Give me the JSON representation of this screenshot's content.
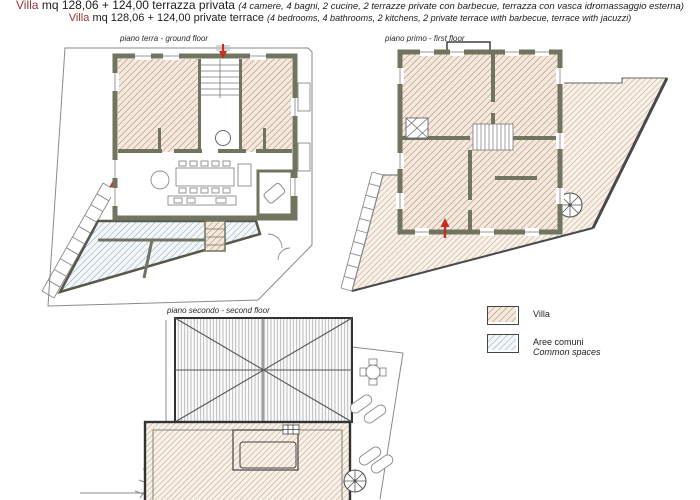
{
  "header": {
    "line1": {
      "brand": "Villa",
      "main": "mq 128,06 + 124,00 terrazza privata",
      "details": "(4 camere, 4 bagni, 2 cucine, 2 terrazze private con barbecue, terrazza con vasca idromassaggio esterna)"
    },
    "line2": {
      "brand": "Villa",
      "main": "mq 128,06 + 124,00 private terrace",
      "details": "(4 bedrooms, 4 bathrooms, 2 kitchens, 2 private terrace with barbecue, terrace with jacuzzi)"
    }
  },
  "plans": {
    "ground": {
      "label": "piano terra - ground floor"
    },
    "first": {
      "label": "piano primo - first floor"
    },
    "second": {
      "label": "piano secondo - second floor"
    }
  },
  "legend": {
    "items": [
      {
        "label": "Villa"
      },
      {
        "label": "Aree comuni",
        "label_en": "Common spaces"
      }
    ]
  },
  "colors": {
    "brand_red": "#9a3434",
    "arrow_red": "#c62f20",
    "wall_olive": "#71755f",
    "hatch_villa": "#ad7f63",
    "hatch_common": "#8ba3b8",
    "roof_line": "#9a9a9a"
  }
}
